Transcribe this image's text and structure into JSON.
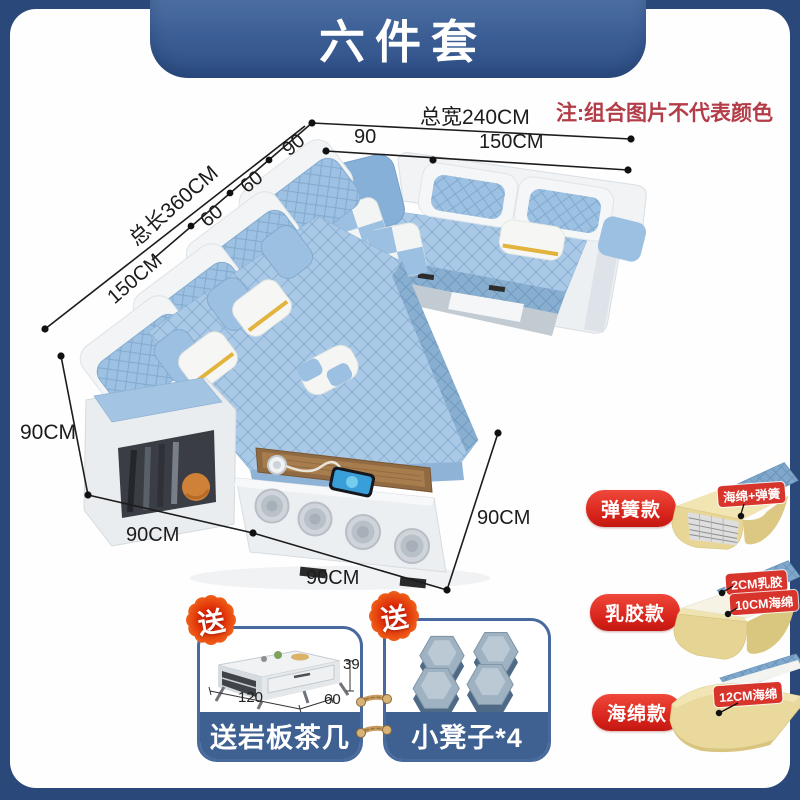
{
  "banner": {
    "title": "六件套"
  },
  "note": {
    "text": "注:组合图片不代表颜色"
  },
  "dimensions": {
    "total_width": "总宽240CM",
    "top_left_seg": "90",
    "top_right_seg": "150CM",
    "diag_seg_90": "90",
    "diag_seg_60a": "60",
    "diag_seg_60b": "60",
    "total_length": "总长360CM",
    "left_seg_150": "150CM",
    "left_height": "90CM",
    "bottom_left_width": "90CM",
    "bottom_mid_width": "90CM",
    "right_depth": "90CM"
  },
  "variants": [
    {
      "name": "弹簧款",
      "tags": [
        "海绵+弹簧"
      ]
    },
    {
      "name": "乳胶款",
      "tags": [
        "2CM乳胶",
        "10CM海绵"
      ]
    },
    {
      "name": "海绵款",
      "tags": [
        "12CM海绵"
      ]
    }
  ],
  "gifts": {
    "badge_label": "送",
    "tea_table": {
      "label": "送岩板茶几",
      "length": "120",
      "depth": "60",
      "height": "39"
    },
    "stools": {
      "label": "小凳子*4"
    }
  },
  "colors": {
    "frame_navy": "#2a4879",
    "banner_blue": "#3d6193",
    "note_red": "#b23d48",
    "accent_red": "#d7342c",
    "strip_blue": "#3f6191",
    "sofa_blue": "#a9c9e6",
    "foam_cream": "#e6d494"
  }
}
